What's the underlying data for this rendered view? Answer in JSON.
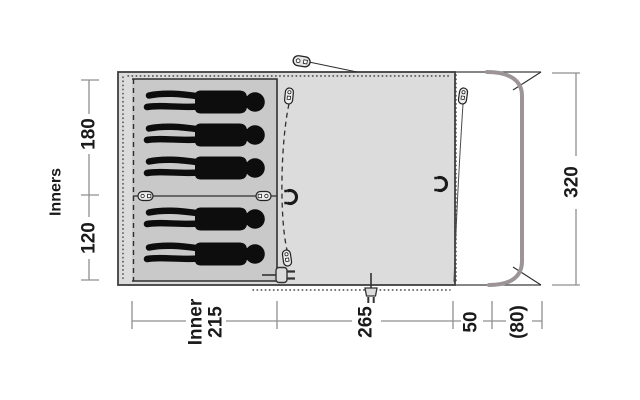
{
  "figure": {
    "type": "tent-floorplan-top-view",
    "sleeping_capacity": 5,
    "inner_sections": [
      {
        "width_cm": "180",
        "persons": 3
      },
      {
        "width_cm": "120",
        "persons": 2
      }
    ]
  },
  "dimensions": {
    "left": {
      "label": "Inners",
      "segments": [
        {
          "value": "180"
        },
        {
          "value": "120"
        }
      ]
    },
    "right": {
      "value": "320"
    },
    "bottom": {
      "segments": [
        {
          "line1": "Inner",
          "line2": "215"
        },
        {
          "value": "265"
        },
        {
          "value": "50"
        },
        {
          "value": "(80)"
        }
      ]
    }
  },
  "icons": [
    "guy-line-peg",
    "zipper-pull-horizontal-left",
    "zipper-pull-horizontal-right",
    "zipper-pull-vertical-inner-top",
    "zipper-pull-vertical-inner-bottom",
    "zipper-pull-vertical-front-door",
    "toggle-hook-inner",
    "toggle-hook-front",
    "power-inlet-plug",
    "cable-entry-plug"
  ],
  "colors": {
    "background": "#ffffff",
    "body_fill": "#dcdcdc",
    "inner_fill": "#c9c9c9",
    "outline": "#3f3f3f",
    "pole": "#9c9496",
    "dimension_line": "#8f8f8f",
    "text": "#1a1a1a",
    "person": "#0d0d0d"
  }
}
